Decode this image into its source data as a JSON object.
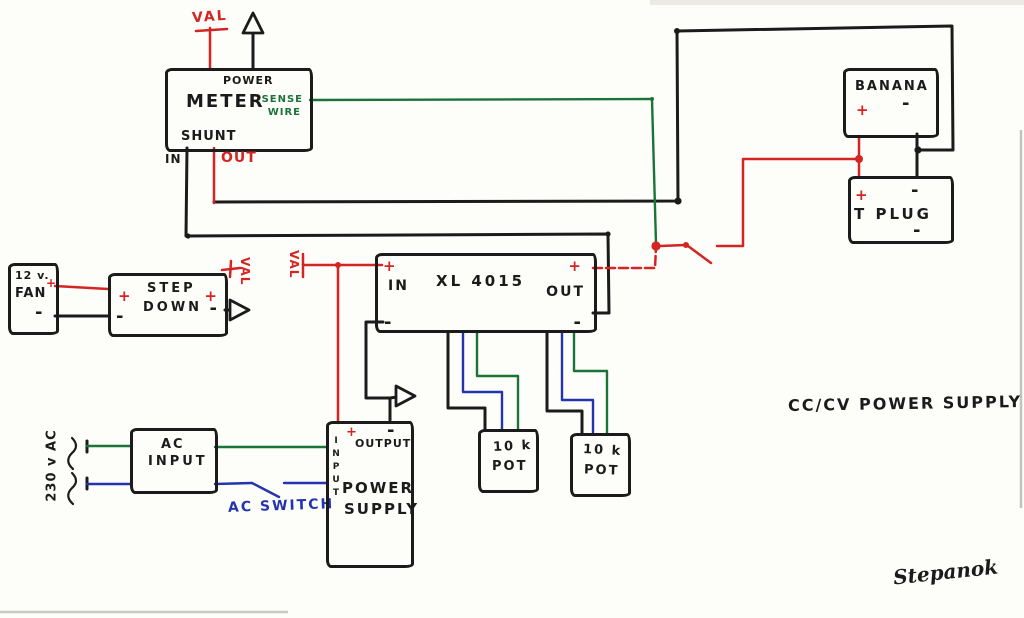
{
  "title": "CC/CV  POWER SUPPLY",
  "signature": "Stepanok",
  "labels": {
    "val": "VAL"
  },
  "meter": {
    "power": "POWER",
    "name": "METER",
    "sense_line1": "SENSE",
    "sense_line2": "WIRE",
    "shunt": "SHUNT",
    "in_label": "IN",
    "out_label": "OUT"
  },
  "banana": {
    "name": "BANANA",
    "plus": "+",
    "minus": "-"
  },
  "tplug": {
    "name": "T PLUG",
    "plus": "+",
    "minus_top": "-",
    "minus_bottom": "-"
  },
  "xl4015": {
    "name": "XL 4015",
    "in_label": "IN",
    "out_label": "OUT",
    "plus_in": "+",
    "plus_out": "+",
    "minus_in": "-",
    "minus_out": "-"
  },
  "fan": {
    "voltage": "12 v.",
    "name": "FAN",
    "plus": "+",
    "minus": "-"
  },
  "stepdown": {
    "line1": "STEP",
    "line2": "DOWN",
    "plus_left": "+",
    "plus_right": "+",
    "minus_left": "-",
    "minus_right": "-"
  },
  "ac_input": {
    "line1": "AC",
    "line2": "INPUT",
    "source": "230 v AC",
    "switch_label": "AC SWITCH"
  },
  "power_supply": {
    "input_vertical": "INPUT",
    "output": "OUTPUT",
    "line1": "POWER",
    "line2": "SUPPLY",
    "plus": "+",
    "minus": "-"
  },
  "pot1": {
    "value": "10 k",
    "name": "POT"
  },
  "pot2": {
    "value": "10 k",
    "name": "POT"
  },
  "colors": {
    "ink": "#1b1b1b",
    "red": "#d42522",
    "green": "#1b7437",
    "blue": "#2334ad",
    "paper": "#fdfdfa"
  }
}
